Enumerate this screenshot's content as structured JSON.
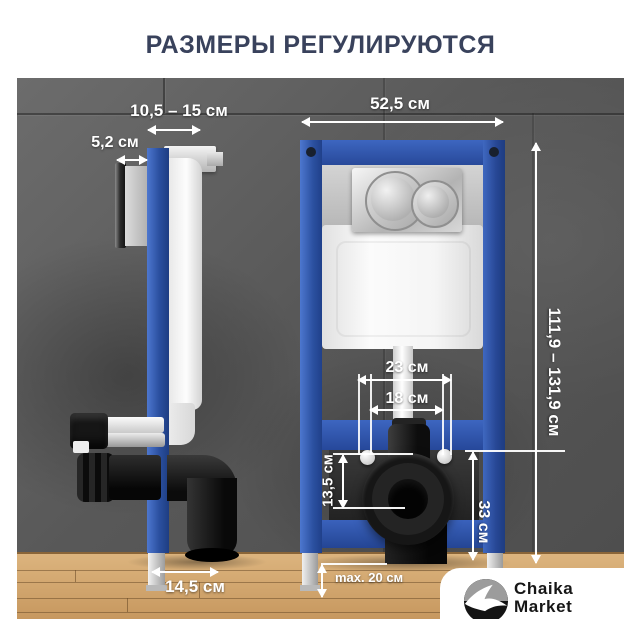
{
  "title": "РАЗМЕРЫ РЕГУЛИРУЮТСЯ",
  "annotations": {
    "mount_depth_range": "10,5 – 15 см",
    "plate_depth": "5,2 см",
    "frame_width": "52,5 см",
    "frame_height_range": "111,9 – 131,9 см",
    "stud_spacing_outer": "23 см",
    "stud_spacing_inner": "18 см",
    "outlet_drop": "13,5 см",
    "outlet_height": "33 см",
    "foot_extension_max": "max. 20 см",
    "outlet_depth": "14,5 см"
  },
  "brand": {
    "name_line1": "Chaika",
    "name_line2": "Market",
    "icon": "seagull-icon"
  },
  "colors": {
    "frame_blue": "#2b50a0",
    "title_navy": "#39425c",
    "annotation_white": "#ffffff",
    "wall_gray": "#585858",
    "floor_wood": "#d2a873",
    "logo_black": "#141414"
  }
}
